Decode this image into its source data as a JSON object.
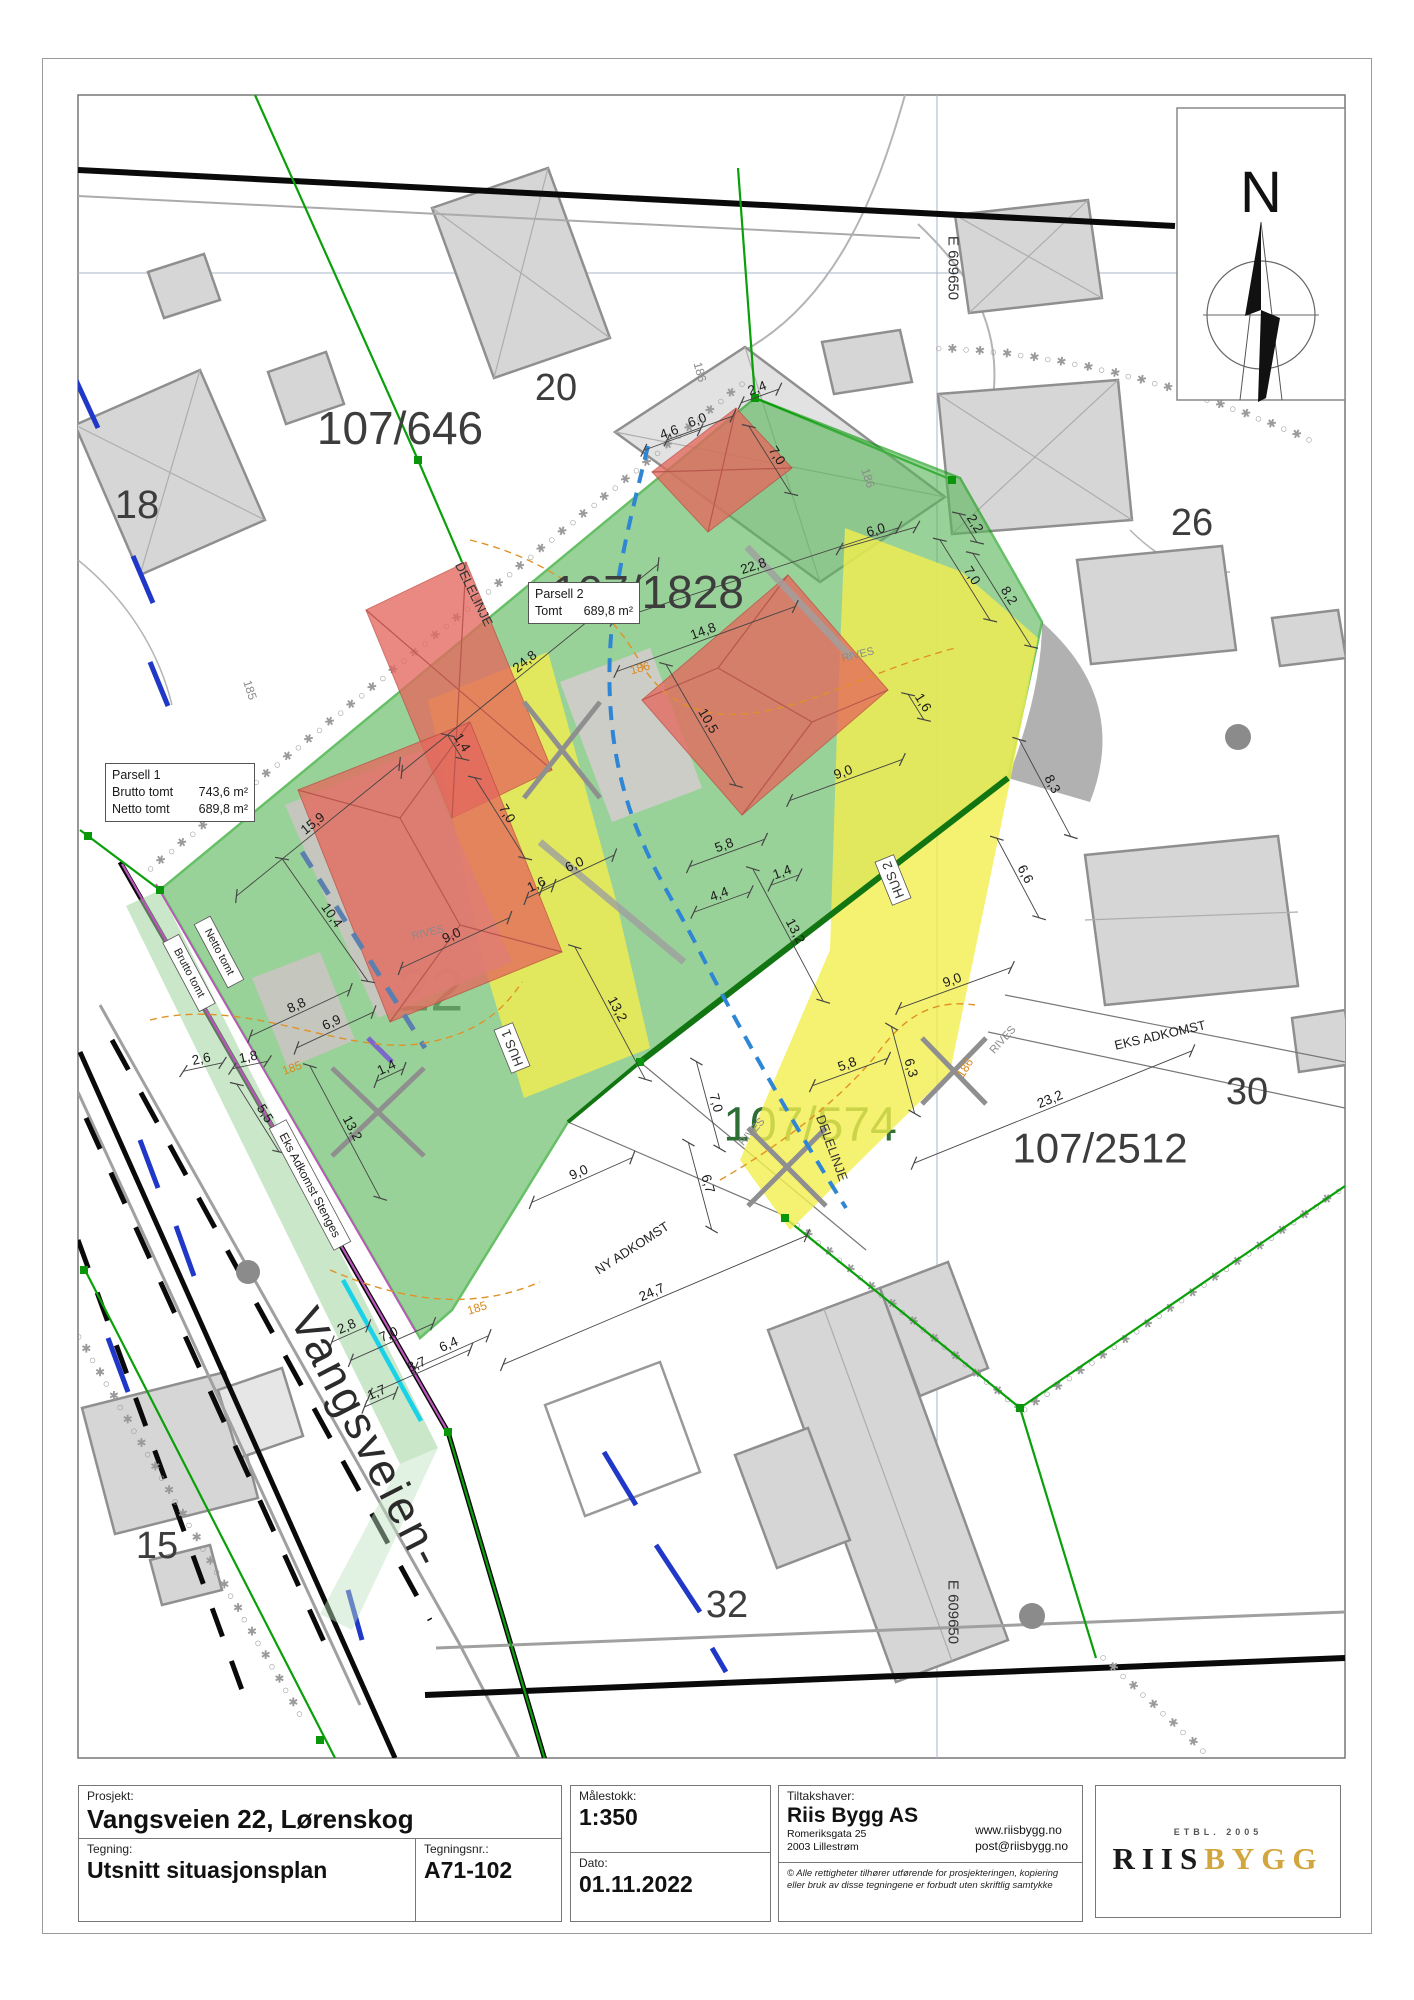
{
  "title_block": {
    "project_label": "Prosjekt:",
    "project": "Vangsveien 22, Lørenskog",
    "drawing_label": "Tegning:",
    "drawing": "Utsnitt situasjonsplan",
    "drawing_no_label": "Tegningsnr.:",
    "drawing_no": "A71-102",
    "scale_label": "Målestokk:",
    "scale": "1:350",
    "date_label": "Dato:",
    "date": "01.11.2022",
    "client_label": "Tiltakshaver:",
    "client": "Riis Bygg AS",
    "client_address1": "Romeriksgata 25",
    "client_address2": "2003 Lillestrøm",
    "client_web": "www.riisbygg.no",
    "client_email": "post@riisbygg.no",
    "copyright_line1": "© Alle rettigheter tilhører utførende for prosjekteringen, kopiering",
    "copyright_line2": "eller bruk av disse tegningene er forbudt uten skriftlig samtykke",
    "logo_etbl": "ETBL. 2005",
    "logo_riis": "RIIS",
    "logo_bygg": "BYGG",
    "logo_gold_color": "#d2a63e"
  },
  "compass": {
    "label": "N"
  },
  "grid": {
    "easting_label": "E 609650"
  },
  "info_boxes": {
    "parsell1": {
      "title": "Parsell 1",
      "rows": [
        {
          "label": "Brutto tomt",
          "value": "743,6 m²"
        },
        {
          "label": "Netto tomt",
          "value": "689,8 m²"
        }
      ]
    },
    "parsell2": {
      "title": "Parsell 2",
      "rows": [
        {
          "label": "Tomt",
          "value": "689,8 m²"
        }
      ]
    }
  },
  "legend_colors": {
    "site_green": "#5cb85c",
    "driveway_yellow": "#f2ee4e",
    "new_house_red": "#e4695e",
    "boundary_green": "#0aa00a",
    "divide_line_blue": "#2e86d4",
    "contour_orange": "#e09225"
  },
  "map_labels": [
    {
      "t": "107/646",
      "x": 400,
      "y": 428,
      "s": 46,
      "r": 0,
      "c": "#3d3d3d"
    },
    {
      "t": "20",
      "x": 556,
      "y": 388,
      "s": 38,
      "r": 0,
      "c": "#3d3d3d"
    },
    {
      "t": "107/1828",
      "x": 648,
      "y": 592,
      "s": 46,
      "r": 0,
      "c": "#3d3d3d"
    },
    {
      "t": "22",
      "x": 430,
      "y": 990,
      "s": 60,
      "r": 0,
      "c": "#6a6a6a",
      "u": 1
    },
    {
      "t": "107/574",
      "x": 810,
      "y": 1125,
      "s": 48,
      "r": 0,
      "c": "#2e6e35",
      "u": 1
    },
    {
      "t": "107/2512",
      "x": 1100,
      "y": 1148,
      "s": 42,
      "r": 0,
      "c": "#3d3d3d"
    },
    {
      "t": "18",
      "x": 137,
      "y": 505,
      "s": 40,
      "r": 0,
      "c": "#3d3d3d"
    },
    {
      "t": "26",
      "x": 1192,
      "y": 523,
      "s": 38,
      "r": 0,
      "c": "#3d3d3d"
    },
    {
      "t": "30",
      "x": 1247,
      "y": 1092,
      "s": 38,
      "r": 0,
      "c": "#3d3d3d"
    },
    {
      "t": "32",
      "x": 727,
      "y": 1605,
      "s": 38,
      "r": 0,
      "c": "#3d3d3d"
    },
    {
      "t": "15",
      "x": 157,
      "y": 1546,
      "s": 38,
      "r": 0,
      "c": "#3d3d3d"
    },
    {
      "t": "Vangsveien-",
      "x": 368,
      "y": 1438,
      "s": 46,
      "r": 63,
      "c": "#2b2b2b",
      "ls": 3
    },
    {
      "t": "E 609650",
      "x": 953,
      "y": 268,
      "s": 15,
      "r": 90,
      "c": "#333"
    },
    {
      "t": "E 609650",
      "x": 953,
      "y": 1612,
      "s": 15,
      "r": 90,
      "c": "#333"
    },
    {
      "t": "DELELINJE",
      "x": 474,
      "y": 594,
      "s": 13,
      "r": 64,
      "c": "#333"
    },
    {
      "t": "DELELINJE",
      "x": 832,
      "y": 1148,
      "s": 13,
      "r": 70,
      "c": "#333"
    },
    {
      "t": "HUS 1",
      "x": 512,
      "y": 1048,
      "s": 13,
      "r": -112,
      "c": "#333",
      "box": 1
    },
    {
      "t": "HUS 2",
      "x": 893,
      "y": 880,
      "s": 13,
      "r": -112,
      "c": "#333",
      "box": 1
    },
    {
      "t": "RIVES",
      "x": 428,
      "y": 933,
      "s": 11,
      "r": -14,
      "c": "#8a8a8a"
    },
    {
      "t": "RIVES",
      "x": 858,
      "y": 655,
      "s": 11,
      "r": -14,
      "c": "#8a8a8a"
    },
    {
      "t": "RIVES",
      "x": 1003,
      "y": 1040,
      "s": 11,
      "r": -48,
      "c": "#8a8a8a"
    },
    {
      "t": "RIVES",
      "x": 752,
      "y": 1132,
      "s": 11,
      "r": -48,
      "c": "#8a8a8a"
    },
    {
      "t": "NY ADKOMST",
      "x": 632,
      "y": 1248,
      "s": 13,
      "r": -33,
      "c": "#222"
    },
    {
      "t": "EKS ADKOMST",
      "x": 1160,
      "y": 1035,
      "s": 13,
      "r": -13,
      "c": "#222"
    },
    {
      "t": "Eks Adkomst Stenges",
      "x": 310,
      "y": 1185,
      "s": 12,
      "r": 62,
      "c": "#222",
      "box": 1
    },
    {
      "t": "Brutto tomt",
      "x": 189,
      "y": 973,
      "s": 11,
      "r": 62,
      "c": "#222",
      "box": 1
    },
    {
      "t": "Netto tomt",
      "x": 219,
      "y": 952,
      "s": 11,
      "r": 62,
      "c": "#222",
      "box": 1
    },
    {
      "t": "186",
      "x": 640,
      "y": 668,
      "s": 12,
      "r": -15,
      "c": "#d98a1f"
    },
    {
      "t": "186",
      "x": 965,
      "y": 1068,
      "s": 12,
      "r": -58,
      "c": "#d98a1f"
    },
    {
      "t": "185",
      "x": 292,
      "y": 1068,
      "s": 12,
      "r": -20,
      "c": "#d98a1f"
    },
    {
      "t": "185",
      "x": 477,
      "y": 1308,
      "s": 12,
      "r": -18,
      "c": "#d98a1f"
    },
    {
      "t": "186",
      "x": 868,
      "y": 478,
      "s": 12,
      "r": 72,
      "c": "#8a8a8a"
    },
    {
      "t": "185",
      "x": 250,
      "y": 690,
      "s": 12,
      "r": 72,
      "c": "#8a8a8a"
    },
    {
      "t": "186",
      "x": 700,
      "y": 372,
      "s": 12,
      "r": 75,
      "c": "#8a8a8a"
    }
  ],
  "dimensions": [
    {
      "t": "24,8",
      "x": 530,
      "y": 668,
      "r": -39,
      "len": 330
    },
    {
      "t": "15,9",
      "x": 318,
      "y": 830,
      "r": -39,
      "len": 210
    },
    {
      "t": "10,4",
      "x": 325,
      "y": 920,
      "r": 55,
      "len": 150
    },
    {
      "t": "9,0",
      "x": 455,
      "y": 943,
      "r": -25,
      "len": 120
    },
    {
      "t": "8,8",
      "x": 300,
      "y": 1013,
      "r": -25,
      "len": 110
    },
    {
      "t": "6,9",
      "x": 335,
      "y": 1030,
      "r": -25,
      "len": 85
    },
    {
      "t": "2,6",
      "x": 203,
      "y": 1067,
      "r": -12,
      "len": 40
    },
    {
      "t": "1,8",
      "x": 250,
      "y": 1065,
      "r": -12,
      "len": 36
    },
    {
      "t": "5,5",
      "x": 258,
      "y": 1118,
      "r": 58,
      "len": 80
    },
    {
      "t": "13,2",
      "x": 345,
      "y": 1132,
      "r": 62,
      "len": 150
    },
    {
      "t": "13,2",
      "x": 610,
      "y": 1013,
      "r": 62,
      "len": 150
    },
    {
      "t": "13,2",
      "x": 788,
      "y": 935,
      "r": 62,
      "len": 150
    },
    {
      "t": "1,4",
      "x": 390,
      "y": 1075,
      "r": -25,
      "len": 30
    },
    {
      "t": "1,4",
      "x": 455,
      "y": 747,
      "r": 58,
      "len": 28
    },
    {
      "t": "1,4",
      "x": 785,
      "y": 880,
      "r": -20,
      "len": 30
    },
    {
      "t": "7,0",
      "x": 500,
      "y": 818,
      "r": 58,
      "len": 95
    },
    {
      "t": "7,0",
      "x": 965,
      "y": 580,
      "r": 58,
      "len": 95
    },
    {
      "t": "7,0",
      "x": 392,
      "y": 1342,
      "r": -24,
      "len": 90
    },
    {
      "t": "7,0",
      "x": 708,
      "y": 1105,
      "r": 75,
      "len": 90
    },
    {
      "t": "7,0",
      "x": 770,
      "y": 460,
      "r": 58,
      "len": 80
    },
    {
      "t": "6,0",
      "x": 578,
      "y": 872,
      "r": -25,
      "len": 80
    },
    {
      "t": "6,0",
      "x": 878,
      "y": 538,
      "r": -16,
      "len": 80
    },
    {
      "t": "6,0",
      "x": 700,
      "y": 428,
      "r": -20,
      "len": 70
    },
    {
      "t": "1,6",
      "x": 540,
      "y": 892,
      "r": -25,
      "len": 30
    },
    {
      "t": "1,6",
      "x": 916,
      "y": 707,
      "r": 58,
      "len": 30
    },
    {
      "t": "14,8",
      "x": 706,
      "y": 639,
      "r": -20,
      "len": 190
    },
    {
      "t": "10,5",
      "x": 701,
      "y": 725,
      "r": 60,
      "len": 140
    },
    {
      "t": "5,8",
      "x": 727,
      "y": 853,
      "r": -20,
      "len": 80
    },
    {
      "t": "5,8",
      "x": 850,
      "y": 1072,
      "r": -20,
      "len": 80
    },
    {
      "t": "4,4",
      "x": 722,
      "y": 902,
      "r": -20,
      "len": 60
    },
    {
      "t": "9,0",
      "x": 846,
      "y": 780,
      "r": -20,
      "len": 120
    },
    {
      "t": "9,0",
      "x": 955,
      "y": 988,
      "r": -20,
      "len": 120
    },
    {
      "t": "9,0",
      "x": 582,
      "y": 1180,
      "r": -24,
      "len": 110
    },
    {
      "t": "8,2",
      "x": 1002,
      "y": 600,
      "r": 58,
      "len": 110
    },
    {
      "t": "2,2",
      "x": 968,
      "y": 528,
      "r": 58,
      "len": 34
    },
    {
      "t": "8,3",
      "x": 1045,
      "y": 788,
      "r": 62,
      "len": 110
    },
    {
      "t": "6,6",
      "x": 1018,
      "y": 878,
      "r": 62,
      "len": 90
    },
    {
      "t": "6,3",
      "x": 903,
      "y": 1070,
      "r": 75,
      "len": 90
    },
    {
      "t": "23,2",
      "x": 1053,
      "y": 1107,
      "r": -22,
      "len": 300
    },
    {
      "t": "24,7",
      "x": 655,
      "y": 1300,
      "r": -23,
      "len": 330
    },
    {
      "t": "6,7",
      "x": 700,
      "y": 1186,
      "r": 75,
      "len": 90
    },
    {
      "t": "22,8",
      "x": 756,
      "y": 574,
      "r": -18,
      "len": 300
    },
    {
      "t": "8,7",
      "x": 420,
      "y": 1372,
      "r": -24,
      "len": 110
    },
    {
      "t": "6,4",
      "x": 452,
      "y": 1352,
      "r": -24,
      "len": 80
    },
    {
      "t": "1,7",
      "x": 380,
      "y": 1400,
      "r": -24,
      "len": 34
    },
    {
      "t": "2,8",
      "x": 350,
      "y": 1334,
      "r": -24,
      "len": 40
    },
    {
      "t": "4,6",
      "x": 672,
      "y": 440,
      "r": -20,
      "len": 60
    },
    {
      "t": "2,4",
      "x": 760,
      "y": 396,
      "r": -20,
      "len": 40
    }
  ]
}
